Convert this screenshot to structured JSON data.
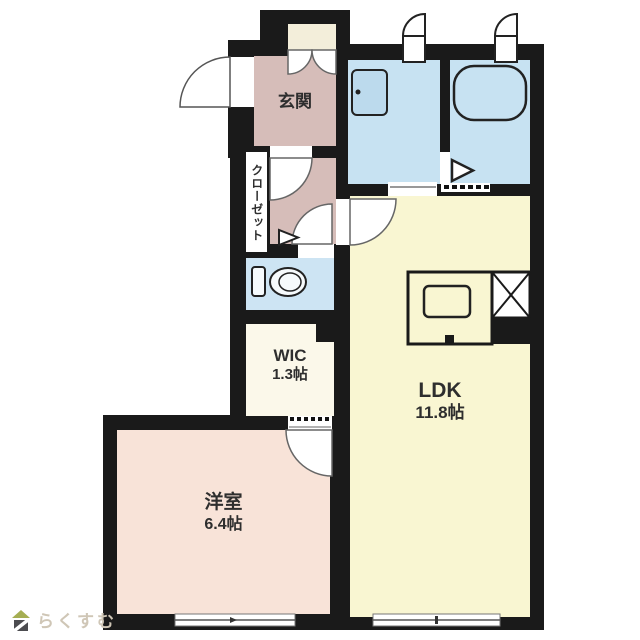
{
  "page": {
    "type": "japanese-apartment-floorplan"
  },
  "rooms": {
    "genkan": {
      "label": "玄関"
    },
    "closet": {
      "label": "クローゼット"
    },
    "wic": {
      "label": "WIC",
      "size": "1.3帖"
    },
    "ldk": {
      "label": "LDK",
      "size": "11.8帖"
    },
    "western": {
      "label": "洋室",
      "size": "6.4帖"
    }
  },
  "fixtures": {
    "toilet": "toilet",
    "sink": "washbasin",
    "bathtub": "bathtub",
    "kitchen": "kitchen-counter-with-sink",
    "refrigerator_space": "x-box"
  },
  "logo": {
    "text": "らくすむ"
  },
  "colors": {
    "wall": "#1a1a1a",
    "genkan_hall": "#d6bdb9",
    "western_room": "#f8e3d8",
    "water_rooms": "#c7e2f2",
    "ldk": "#f9f6d2",
    "wic": "#fbf8ea",
    "storage_nook": "#f3eeda",
    "logo_roof": "#a5ae52",
    "logo_body": "#4c4c50",
    "logo_text": "#cfc6b6"
  }
}
